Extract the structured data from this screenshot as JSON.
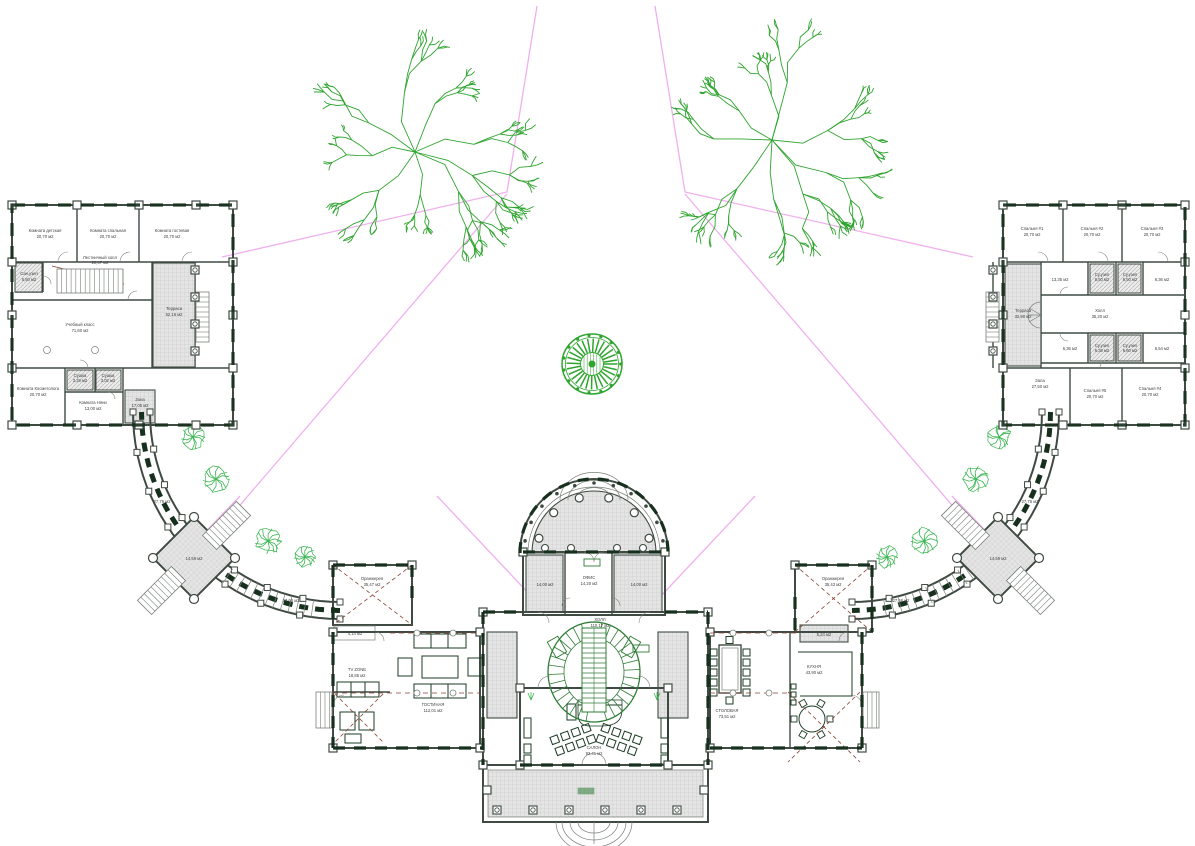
{
  "drawing": {
    "type": "architectural-floor-plan",
    "language": "ru",
    "colors": {
      "paper": "#ffffff",
      "wall": "#3f4a42",
      "wall_dark": "#17301d",
      "thin": "#7a807a",
      "hatch_fill": "#e4e4e4",
      "hatch_line": "#c6c6c6",
      "tree_green": "#2fa42f",
      "bush_green": "#3ab551",
      "plan_green": "#2f7d36",
      "furniture": "#1d3b26",
      "pink": "#f0b0ee",
      "dash_red": "#874233",
      "text": "#3f3f3f"
    }
  },
  "left_wing": {
    "rooms": [
      {
        "name": "Комната детская",
        "area": "20,70 м2"
      },
      {
        "name": "Комната спальная",
        "area": "20,70 м2"
      },
      {
        "name": "Комната гостевая",
        "area": "20,70 м2"
      },
      {
        "name": "Лестничный холл",
        "area": "20,47 м2"
      },
      {
        "name": "Сан.узел",
        "area": "5,50 м2"
      },
      {
        "name": "Учебный класс",
        "area": "71,60 м2"
      },
      {
        "name": "Терраса",
        "area": "52,16 м2"
      },
      {
        "name": "Комната Косметолога",
        "area": "20,70 м2"
      },
      {
        "name": "Сушка",
        "area": "3,29 м2"
      },
      {
        "name": "Сушка",
        "area": "3,02 м2"
      },
      {
        "name": "Комната Няни",
        "area": "13,00 м2"
      },
      {
        "name": "Зона",
        "area": "17,05 м2"
      }
    ]
  },
  "right_wing": {
    "rooms": [
      {
        "name": "Спальня #1",
        "area": "20,70 м2"
      },
      {
        "name": "Спальня #2",
        "area": "20,70 м2"
      },
      {
        "name": "Спальня #3",
        "area": "20,70 м2"
      },
      {
        "name": "",
        "area": "13,35 м2"
      },
      {
        "name": "Су.узел",
        "area": "6,50 м2"
      },
      {
        "name": "Су.узел",
        "area": "6,50 м2"
      },
      {
        "name": "",
        "area": "6,36 м2"
      },
      {
        "name": "Холл",
        "area": "35,20 м2"
      },
      {
        "name": "Су.узел",
        "area": "6,38 м2"
      },
      {
        "name": "Су.узел",
        "area": "6,60 м2"
      },
      {
        "name": "",
        "area": "6,36 м2"
      },
      {
        "name": "",
        "area": "6,54 м2"
      },
      {
        "name": "Зала",
        "area": "27,50 м2"
      },
      {
        "name": "Спальня #5",
        "area": "20,70 м2"
      },
      {
        "name": "Спальня #4",
        "area": "20,70 м2"
      },
      {
        "name": "Терраса",
        "area": "32,90 м2"
      }
    ]
  },
  "center": {
    "rooms": [
      {
        "name": "ОФИС",
        "area": "14,20 м2"
      },
      {
        "name": "",
        "area": "14,00 м2"
      },
      {
        "name": "",
        "area": "14,00 м2"
      },
      {
        "name": "ХОЛЛ",
        "area": "110,17 м2"
      },
      {
        "name": "ГОСТИНАЯ",
        "area": "112,01 м2"
      },
      {
        "name": "TV ZONE",
        "area": "18,85 м2"
      },
      {
        "name": "",
        "area": "4,14 м2"
      },
      {
        "name": "Оранжерея",
        "area": "35,47 м2"
      },
      {
        "name": "СТОЛОВАЯ",
        "area": "73,51 м2"
      },
      {
        "name": "КУХНЯ",
        "area": "43,90 м2"
      },
      {
        "name": "",
        "area": "5,24 м2"
      },
      {
        "name": "Оранжерея",
        "area": "35,43 м2"
      },
      {
        "name": "САЛОН",
        "area": "93,41 м2"
      }
    ]
  },
  "galleries": {
    "left_upper": "27,76 м2",
    "left_lower": "27,66 м2",
    "right_upper": "27,76 м2",
    "right_lower": "27,66 м2",
    "pavilion_left": "14,59 м2",
    "pavilion_right": "14,59 м2"
  }
}
